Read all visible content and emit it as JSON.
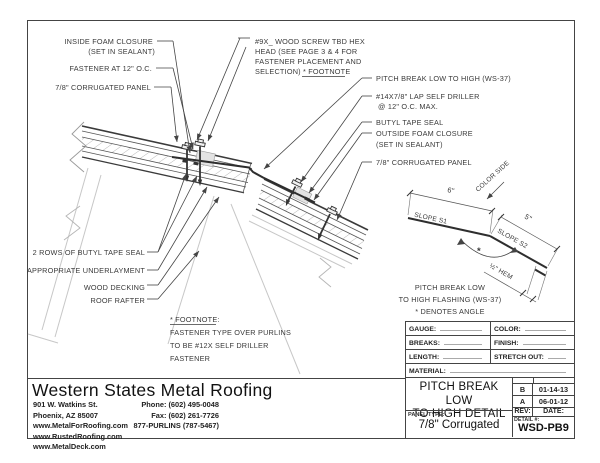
{
  "drawing": {
    "labels": {
      "inside_foam_closure_1": "INSIDE FOAM CLOSURE",
      "inside_foam_closure_2": "(SET IN SEALANT)",
      "fastener_12": "FASTENER AT 12\" O.C.",
      "panel_left": "7/8\" CORRUGATED PANEL",
      "wood_screw_1": "#9X_ WOOD SCREW TBD HEX",
      "wood_screw_2": "HEAD (SEE PAGE 3 & 4 FOR",
      "wood_screw_3": "FASTENER PLACEMENT AND",
      "wood_screw_4": "SELECTION)",
      "wood_screw_footnote": "* FOOTNOTE",
      "pitch_break": "PITCH BREAK LOW TO HIGH (WS-37)",
      "lap_driller_1": "#14X7/8\" LAP SELF DRILLER",
      "lap_driller_2": "@ 12\" O.C. MAX.",
      "butyl_tape": "BUTYL TAPE SEAL",
      "outside_foam_1": "OUTSIDE FOAM CLOSURE",
      "outside_foam_2": "(SET IN SEALANT)",
      "panel_right": "7/8\" CORRUGATED PANEL",
      "butyl_rows": "2 ROWS OF BUTYL TAPE SEAL",
      "underlayment": "APPROPRIATE UNDERLAYMENT",
      "wood_decking": "WOOD DECKING",
      "roof_rafter": "ROOF RAFTER"
    },
    "footnote": {
      "title": "* FOOTNOTE:",
      "line1": "FASTENER TYPE OVER PURLINS",
      "line2": "TO BE #12X SELF DRILLER",
      "line3": "FASTENER"
    },
    "flashing_detail": {
      "color_side": "COLOR SIDE",
      "dim_6": "6\"",
      "dim_5": "5\"",
      "slope_s1": "SLOPE S1",
      "slope_s2": "SLOPE S2",
      "hem": "½\" HEM",
      "angle_marker": "*",
      "caption_1": "PITCH BREAK LOW",
      "caption_2": "TO HIGH FLASHING (WS-37)",
      "caption_3": "* DENOTES ANGLE"
    }
  },
  "company": {
    "name": "Western States Metal Roofing",
    "address_1": "901 W. Watkins St.",
    "address_2": "Phoenix, AZ 85007",
    "web_1": "www.MetalForRoofing.com",
    "web_2": "www.RustedRoofing.com",
    "web_3": "www.MetalDeck.com",
    "phone": "Phone: (602) 495-0048",
    "fax": "Fax: (602) 261-7726",
    "tollfree": "877-PURLINS (787-5467)"
  },
  "title_block": {
    "gauge": "GAUGE:",
    "color": "COLOR:",
    "breaks": "BREAKS:",
    "finish": "FINISH:",
    "length": "LENGTH:",
    "stretch_out": "STRETCH OUT:",
    "material": "MATERIAL:",
    "title_1": "PITCH BREAK LOW",
    "title_2": "TO HIGH DETAIL",
    "panel_type_label": "PANEL TYPE:",
    "panel_type": "7/8\" Corrugated",
    "rev_label": "REV:",
    "date_label": "DATE:",
    "revisions": [
      {
        "rev": "B",
        "date": "01-14-13"
      },
      {
        "rev": "A",
        "date": "06-01-12"
      }
    ],
    "detail_label": "DETAIL #:",
    "detail_number": "WSD-PB9"
  }
}
